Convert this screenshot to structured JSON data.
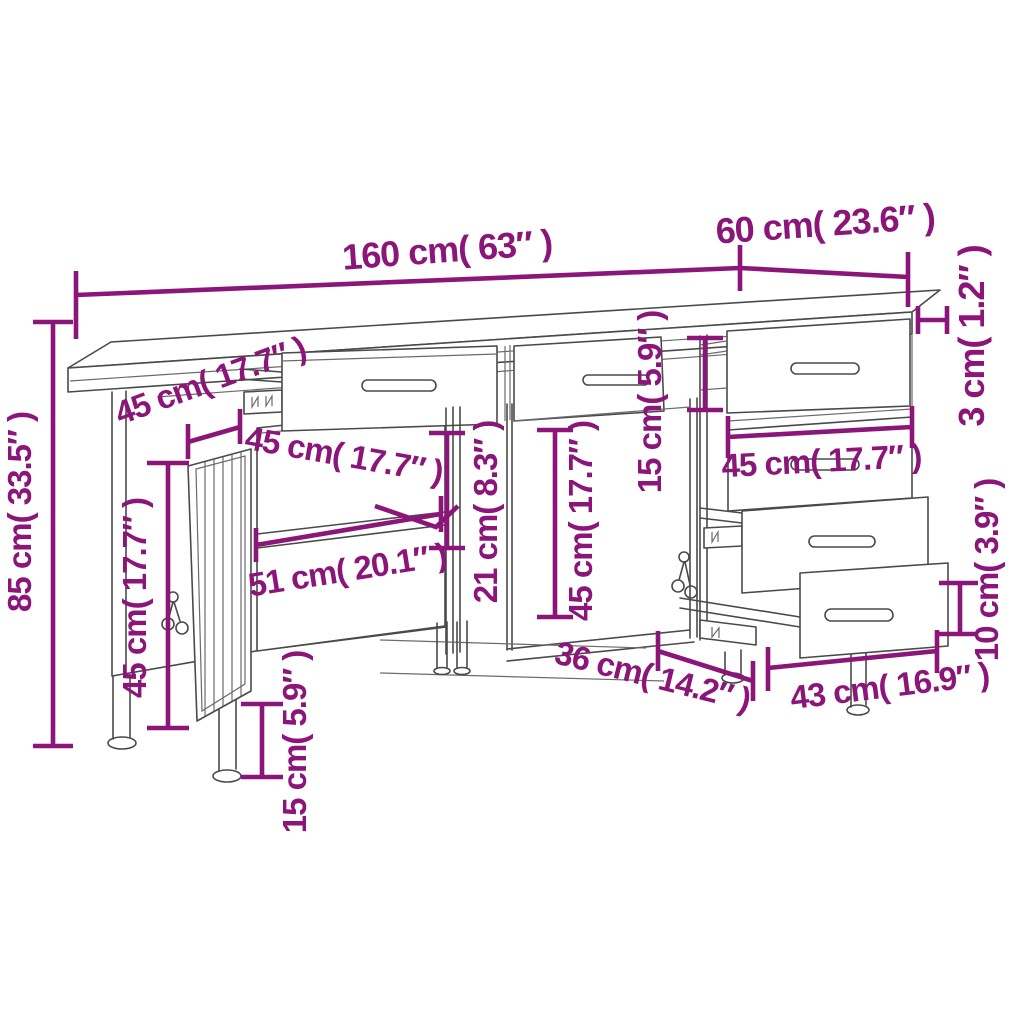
{
  "page": {
    "background": "#ffffff",
    "description": "Technical dimension drawing of a workbench sideboard with a locking door cabinet, open shelves and pull-out drawers"
  },
  "colors": {
    "dimension_accent": "#8B1579",
    "drawing_line": "#4a4a4a"
  },
  "dimensions": {
    "total_width": {
      "text": "160 cm( 63″ )",
      "cm": 160,
      "inches": 63
    },
    "total_depth": {
      "text": "60 cm( 23.6″ )",
      "cm": 60,
      "inches": 23.6
    },
    "worktop_thickness": {
      "text": "3 cm( 1.2″ )",
      "cm": 3,
      "inches": 1.2
    },
    "total_height": {
      "text": "85 cm( 33.5″ )",
      "cm": 85,
      "inches": 33.5
    },
    "top_drawer_depth": {
      "text": "45 cm( 17.7″ )",
      "cm": 45,
      "inches": 17.7
    },
    "shelf_depth": {
      "text": "45 cm( 17.7″ )",
      "cm": 45,
      "inches": 17.7
    },
    "door_height": {
      "text": "45 cm( 17.7″ )",
      "cm": 45,
      "inches": 17.7
    },
    "cabinet_shelf_width": {
      "text": "51 cm( 20.1″ )",
      "cm": 51,
      "inches": 20.1
    },
    "shelf_opening_height": {
      "text": "21 cm( 8.3″ )",
      "cm": 21,
      "inches": 8.3
    },
    "middle_opening_height": {
      "text": "45 cm( 17.7″ )",
      "cm": 45,
      "inches": 17.7
    },
    "drawer_front_height": {
      "text": "15 cm( 5.9″ )",
      "cm": 15,
      "inches": 5.9
    },
    "right_drawer_width": {
      "text": "45 cm( 17.7″ )",
      "cm": 45,
      "inches": 17.7
    },
    "bottom_compartment_depth": {
      "text": "36 cm( 14.2″ )",
      "cm": 36,
      "inches": 14.2
    },
    "bottom_drawer_width": {
      "text": "43 cm( 16.9″ )",
      "cm": 43,
      "inches": 16.9
    },
    "bottom_drawer_front_height": {
      "text": "10 cm( 3.9″ )",
      "cm": 10,
      "inches": 3.9
    },
    "leg_height": {
      "text": "15 cm( 5.9″ )",
      "cm": 15,
      "inches": 5.9
    }
  }
}
